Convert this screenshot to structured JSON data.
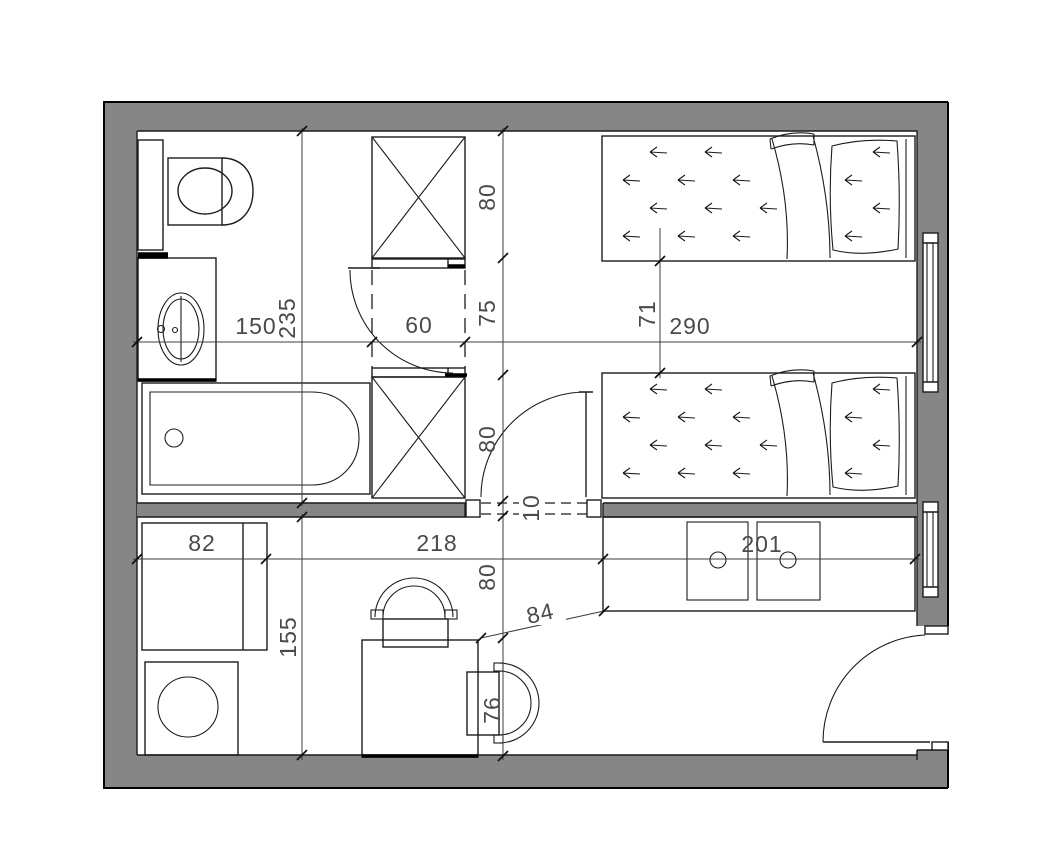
{
  "drawing": {
    "type": "architectural-floor-plan",
    "colors": {
      "wall_fill": "#868686",
      "line": "#1c1c1c",
      "dimension_text": "#4a4a4a",
      "background": "#ffffff"
    },
    "fixtures": [
      "toilet",
      "vanity-sink",
      "bathtub",
      "closet-top",
      "closet-bottom",
      "bed-1",
      "bed-2",
      "window-1",
      "window-2",
      "bathroom-door",
      "bedroom-door",
      "entrance-door",
      "cabinet",
      "washing-machine",
      "desk",
      "chair-top",
      "chair-side",
      "counter-two-hobs"
    ]
  },
  "dims": {
    "d150": "150",
    "d60": "60",
    "d290": "290",
    "d235": "235",
    "d71": "71",
    "d80a": "80",
    "d75": "75",
    "d80b": "80",
    "d10": "10",
    "d80c": "80",
    "d76": "76",
    "d82": "82",
    "d218": "218",
    "d201": "201",
    "d155": "155",
    "d84": "84"
  }
}
